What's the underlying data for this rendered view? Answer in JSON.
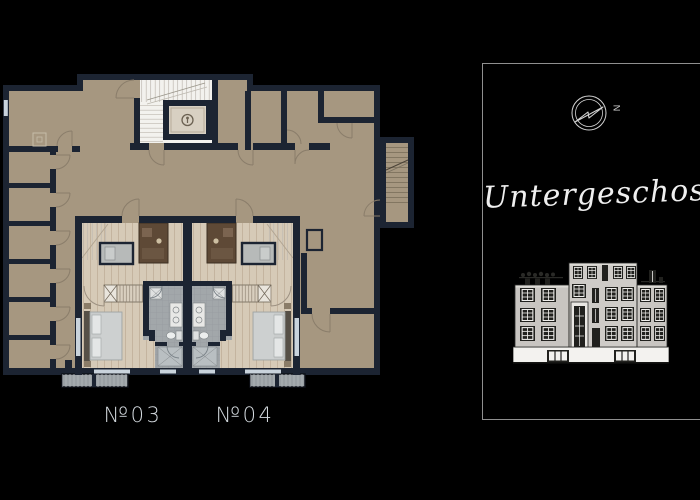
{
  "floorplan": {
    "unit_labels": [
      {
        "id": "03",
        "text": "№03"
      },
      {
        "id": "04",
        "text": "№04"
      }
    ]
  },
  "panel": {
    "floor_title": "Untergeschoss",
    "compass_north_label": "N"
  },
  "colors": {
    "bg": "#000000",
    "wall": "#1c2432",
    "floor": "#a69780",
    "wood": "#d6cab7",
    "bath": "#a2a7aa",
    "stair": "#f3f2ee",
    "bed": "#c9cccc",
    "cabinet": "#5e4936",
    "window": "#c9d3dc",
    "lightwell": "#9aa0a4",
    "label": "#d3d9de",
    "panel_border": "#8f8f8f",
    "line": "#d3d3d3",
    "title": "#efefef",
    "elev_face": "#c8c5c1",
    "elev_dark": "#21211e",
    "elev_white": "#f3f2ef"
  }
}
